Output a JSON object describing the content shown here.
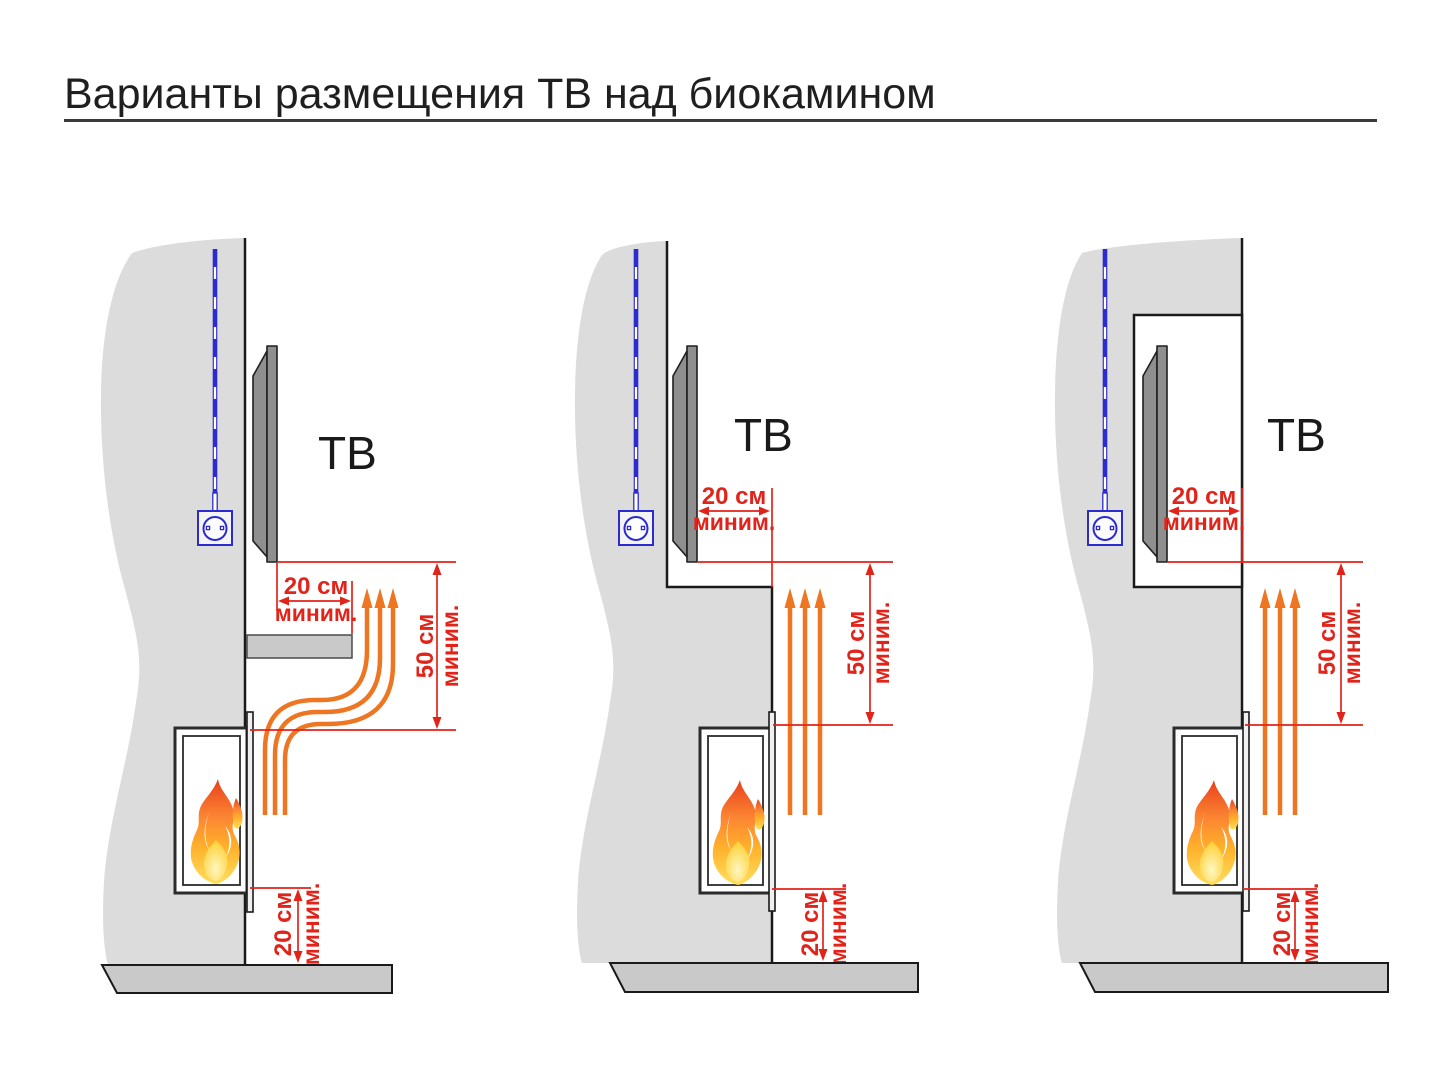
{
  "title": "Варианты размещения ТВ над биокамином",
  "colors": {
    "dimension_red": "#e2231a",
    "heat_arrow_orange": "#ee7521",
    "cable_blue": "#2b2bd0",
    "wall_gray": "#dcdcdc",
    "floor_gray": "#c9c9c9",
    "tv_gray": "#8f8f8f",
    "title_black": "#1f1f1f"
  },
  "variants": [
    {
      "id": "tv-above-shelf",
      "tv": "ТВ",
      "side_clearance": "20 см",
      "side_min": "миним.",
      "height_clearance": "50 см",
      "height_min": "миним.",
      "floor_clearance": "20 см",
      "floor_min": "миним."
    },
    {
      "id": "tv-on-recessed-wall",
      "tv": "ТВ",
      "side_clearance": "20 см",
      "side_min": "миним.",
      "height_clearance": "50 см",
      "height_min": "миним.",
      "floor_clearance": "20 см",
      "floor_min": "миним."
    },
    {
      "id": "tv-in-niche",
      "tv": "ТВ",
      "side_clearance": "20 см",
      "side_min": "миним.",
      "height_clearance": "50 см",
      "height_min": "миним.",
      "floor_clearance": "20 см",
      "floor_min": "миним."
    }
  ]
}
